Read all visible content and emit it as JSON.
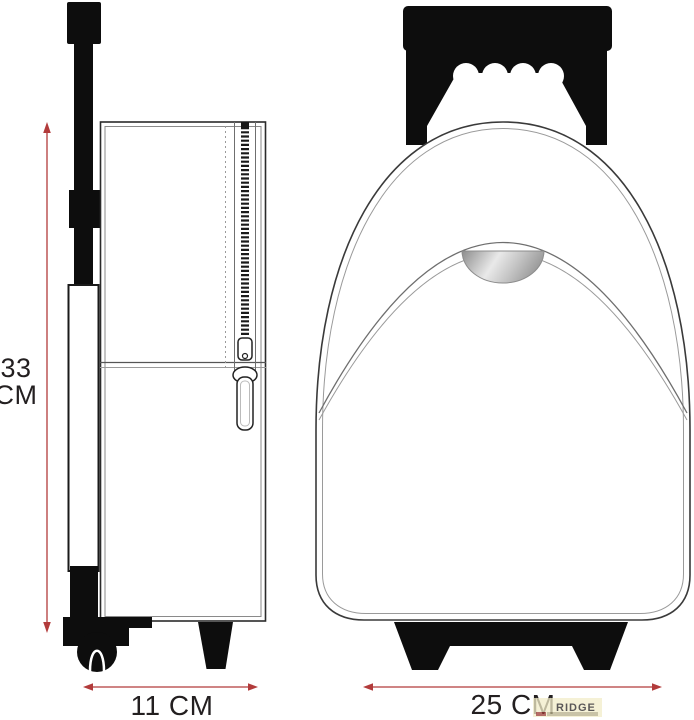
{
  "diagram": {
    "subject": "trolley backpack dimension drawing",
    "views": 2
  },
  "dimensions": {
    "height": {
      "line1": "33",
      "line2": "CM",
      "value_cm": 33
    },
    "depth": {
      "label": "11 CM",
      "value_cm": 11
    },
    "width": {
      "label": "25 CM",
      "value_cm": 25
    }
  },
  "watermark": {
    "text": "RIDGE"
  },
  "colors": {
    "background": "#ffffff",
    "ink": "#231f20",
    "line_art": "#3a3a3a",
    "line_art_light": "#9a9a9a",
    "solid_black": "#0d0d0d",
    "dimension_line": "#b23b3b",
    "grab_handle_dark": "#8d8d8d",
    "grab_handle_light": "#e9e9e9",
    "watermark_text": "#8a8040",
    "watermark_bg": "#f2edc9"
  }
}
